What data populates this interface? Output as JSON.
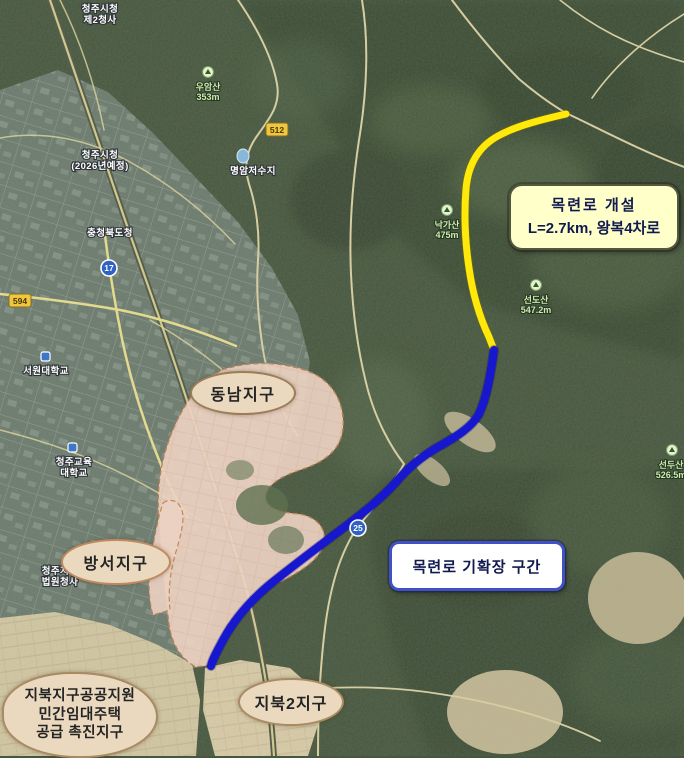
{
  "colors": {
    "route_new": "#ffe80a",
    "route_widened": "#1717cf",
    "callout_new_bg": "#feffc9",
    "callout_widened_border": "#3f51c4",
    "district_pill_bg": "#ead9bf",
    "district_overlay": "#ecd2c2"
  },
  "callouts": {
    "new_road": {
      "line1": "목련로 개설",
      "line2": "L=2.7km, 왕복4차로"
    },
    "widened_section": "목련로 기확장 구간"
  },
  "districts": {
    "dongnam": "동남지구",
    "bangseo": "방서지구",
    "jibuk2": "지북2지구",
    "jibuk_promo": {
      "line1": "지북지구공공지원",
      "line2": "민간임대주택",
      "line3": "공급 촉진지구"
    }
  },
  "badges": [
    {
      "num": "512"
    },
    {
      "num": "594"
    },
    {
      "num": "17"
    },
    {
      "num": "25"
    }
  ],
  "pois": [
    {
      "lines": [
        "청주시청",
        "제2청사"
      ]
    },
    {
      "lines": [
        "명암저수지",
        ""
      ]
    },
    {
      "lines": [
        "우암산",
        "353m"
      ]
    },
    {
      "lines": [
        "충청북도청",
        ""
      ]
    },
    {
      "lines": [
        "청주시청",
        "(2026년예정)"
      ]
    },
    {
      "lines": [
        "낙가산",
        "475m"
      ]
    },
    {
      "lines": [
        "선도산",
        "547.2m"
      ]
    },
    {
      "lines": [
        "선두산",
        "526.5m"
      ]
    },
    {
      "lines": [
        "서원대학교",
        ""
      ]
    },
    {
      "lines": [
        "청주교육",
        "대학교"
      ]
    },
    {
      "lines": [
        "청주지방",
        "법원청사"
      ]
    }
  ]
}
